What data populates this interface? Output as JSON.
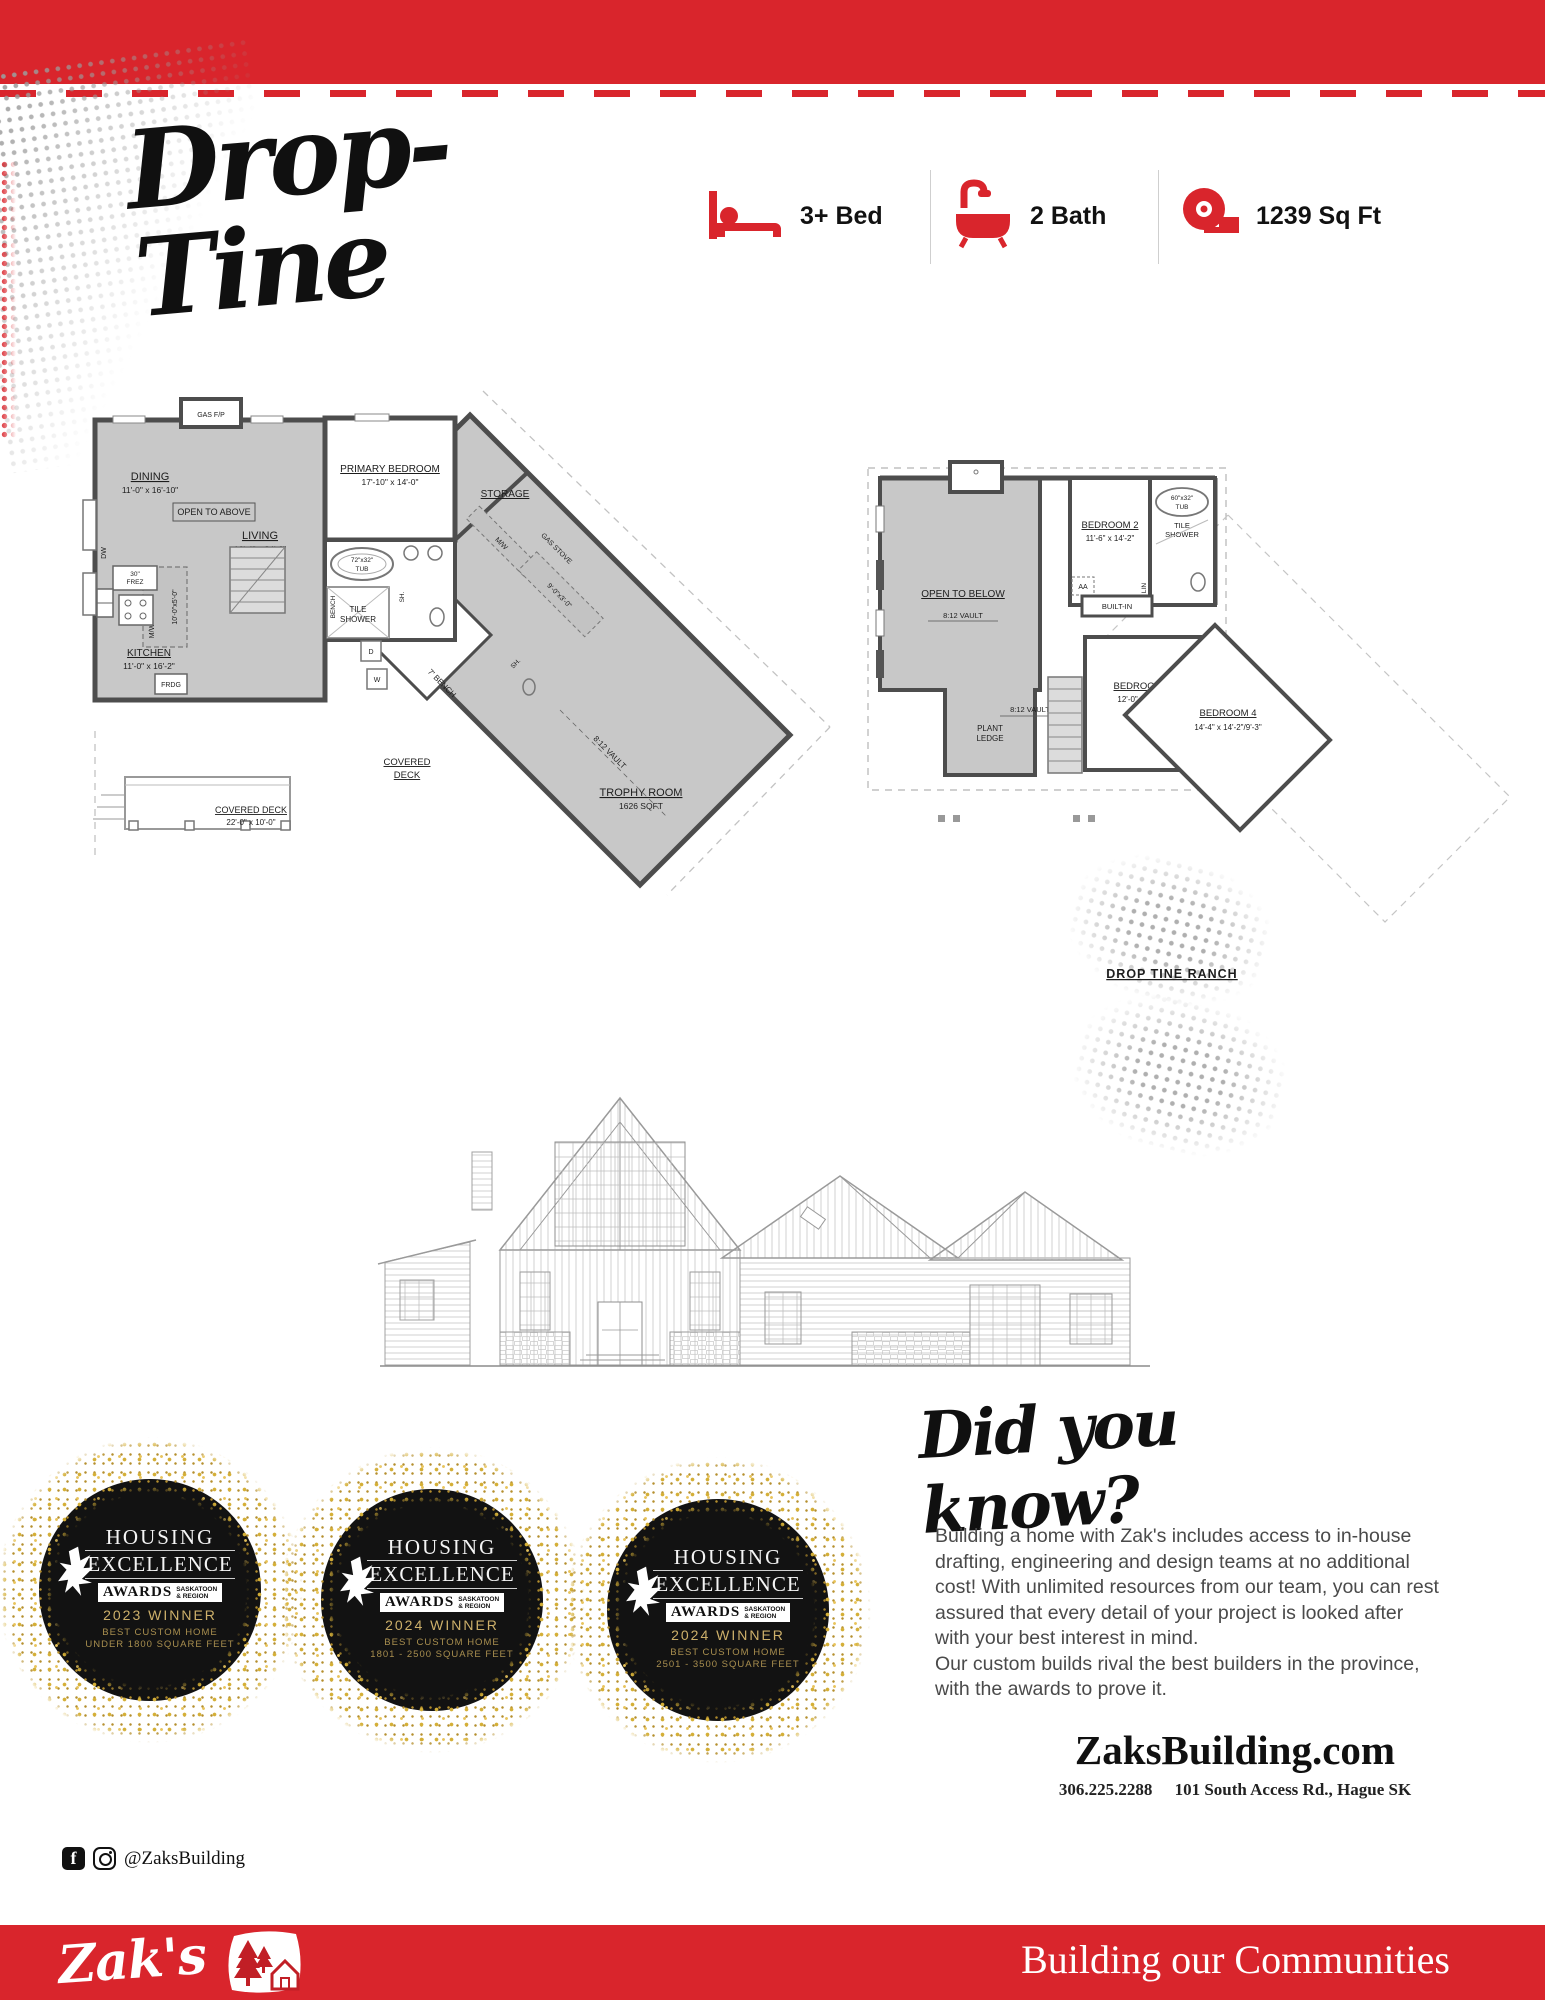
{
  "colors": {
    "brand_red": "#d9252c",
    "badge_gold": "#cdb06a",
    "plan_gray": "#c8c8c8"
  },
  "header": {
    "title": "Drop-Tine",
    "specs": [
      {
        "icon": "bed-icon",
        "label": "3+ Bed"
      },
      {
        "icon": "bath-icon",
        "label": "2 Bath"
      },
      {
        "icon": "tape-measure-icon",
        "label": "1239 Sq Ft"
      }
    ]
  },
  "main_floor": {
    "gas_fp": "GAS F/P",
    "dining": "DINING",
    "dining_dims": "11'-0\" x 16'-10\"",
    "open_to_above": "OPEN TO ABOVE",
    "living": "LIVING",
    "living_dims": "16'-4\" x 24'-6\"",
    "primary_bedroom": "PRIMARY BEDROOM",
    "primary_bedroom_dims": "17'-10\" x 14'-0\"",
    "storage": "STORAGE",
    "tub_l1": "72\"x32\"",
    "tub_l2": "TUB",
    "bench": "BENCH",
    "tile_l1": "TILE",
    "tile_l2": "SHOWER",
    "sh": "SH.",
    "kitchen": "KITCHEN",
    "kitchen_dims": "11'-0\" x 16'-2\"",
    "frdg": "FRDG",
    "frez_l1": "30\"",
    "frez_l2": "FREZ",
    "dw": "DW",
    "mw": "M/W",
    "island_dims": "10'-0\"x5'-0\"",
    "d": "D",
    "w": "W",
    "bench7": "7' BENCH",
    "covered_l1": "COVERED",
    "covered_l2": "DECK",
    "covered_deck2": "COVERED DECK",
    "covered_deck2_dims": "22'-0\" x 10'-0\"",
    "trophy_room": "TROPHY ROOM",
    "trophy_sqft": "1626 SQFT",
    "vault": "8:12 VAULT",
    "gas_stove": "GAS STOVE",
    "island2_dims": "9'-0\"x3'-0\""
  },
  "second_floor": {
    "open_to_below": "OPEN TO BELOW",
    "vault1": "8:12 VAULT",
    "vault2": "8:12 VAULT",
    "plant_l1": "PLANT",
    "plant_l2": "LEDGE",
    "bedroom2": "BEDROOM 2",
    "bedroom2_dims": "11'-6\" x 14'-2\"",
    "tub_l1": "60\"x32\"",
    "tub_l2": "TUB",
    "tile_l1": "TILE",
    "tile_l2": "SHOWER",
    "aa": "AA",
    "lin": "LIN",
    "built_in": "BUILT-IN",
    "bedroom3": "BEDROOM 3",
    "bedroom3_dims": "12'-0\" x 12'-4\"",
    "bedroom4": "BEDROOM 4",
    "bedroom4_dims": "14'-4\" x 14'-2\"/9'-3\"",
    "caption": "DROP TINE RANCH"
  },
  "awards": [
    {
      "title1": "HOUSING",
      "title2": "EXCELLENCE",
      "awards": "AWARDS",
      "region_l1": "SASKATOON",
      "region_l2": "& REGION",
      "year": "2023 WINNER",
      "cat1": "BEST CUSTOM HOME",
      "cat2": "UNDER 1800 SQUARE FEET"
    },
    {
      "title1": "HOUSING",
      "title2": "EXCELLENCE",
      "awards": "AWARDS",
      "region_l1": "SASKATOON",
      "region_l2": "& REGION",
      "year": "2024 WINNER",
      "cat1": "BEST CUSTOM HOME",
      "cat2": "1801 - 2500 SQUARE FEET"
    },
    {
      "title1": "HOUSING",
      "title2": "EXCELLENCE",
      "awards": "AWARDS",
      "region_l1": "SASKATOON",
      "region_l2": "& REGION",
      "year": "2024 WINNER",
      "cat1": "BEST CUSTOM HOME",
      "cat2": "2501 - 3500 SQUARE FEET"
    }
  ],
  "did_you_know": {
    "heading": "Did you know?",
    "body": "Building a home with Zak's includes access to in-house\ndrafting, engineering and design teams at no additional\ncost! With unlimited resources from our team, you can rest\nassured that every detail of your project is looked after\nwith your best interest in mind.\nOur custom builds rival the best builders in the province,\nwith the awards to prove it."
  },
  "contact": {
    "website": "ZaksBuilding.com",
    "phone": "306.225.2288",
    "address": "101 South Access Rd., Hague SK"
  },
  "social": {
    "handle": "@ZaksBuilding"
  },
  "footer": {
    "brand": "Zak's",
    "tagline": "Building our Communities"
  }
}
